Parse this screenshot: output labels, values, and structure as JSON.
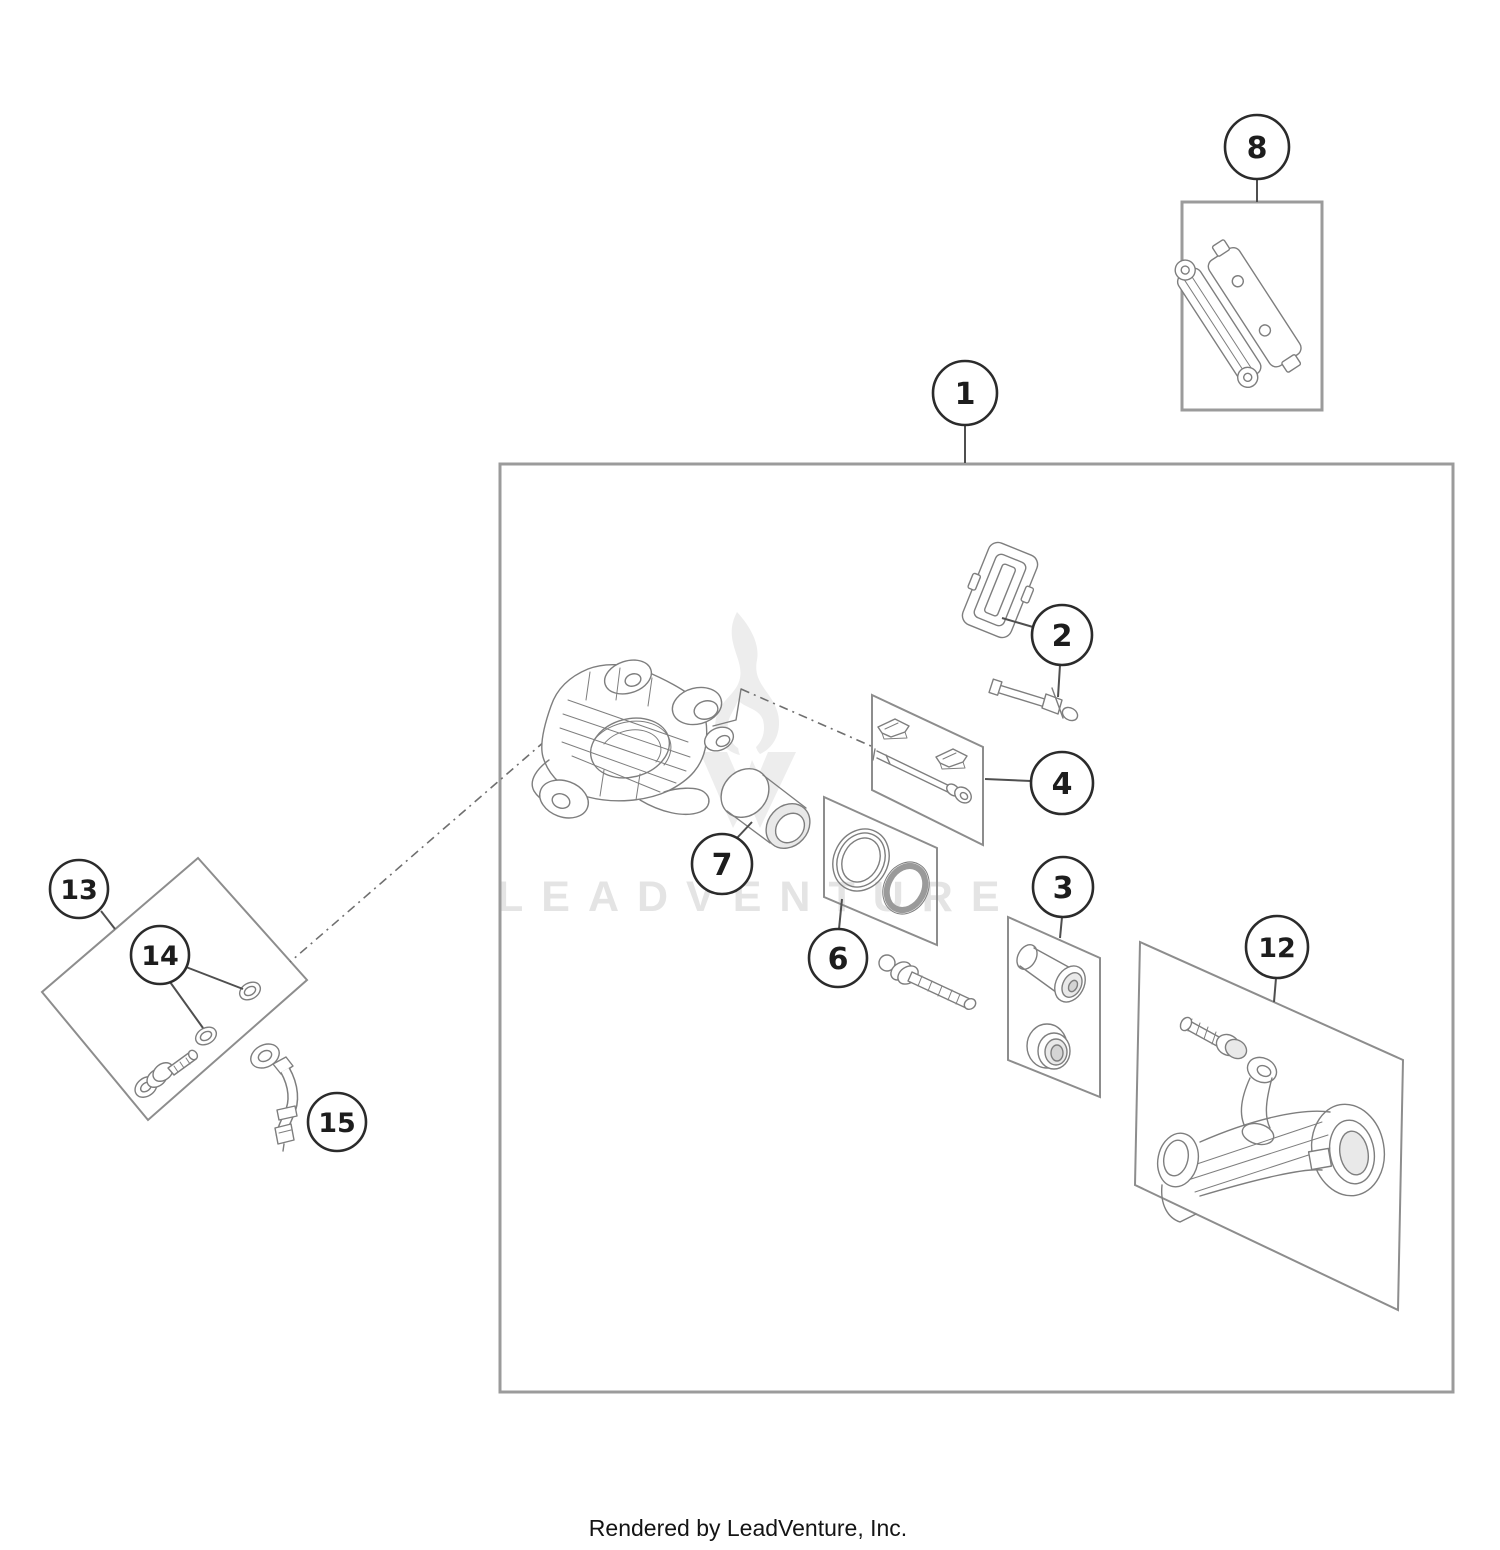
{
  "page": {
    "watermark": "LEADVENTURE",
    "footer": "Rendered by LeadVenture, Inc."
  },
  "colors": {
    "frame": "#9b9b9b",
    "inner_box": "#8d8d8d",
    "callout_stroke": "#2b2b2b",
    "leader": "#4f4f4f",
    "part_line": "#7e7e7e",
    "watermark": "#e4e4e4",
    "footer_text": "#141414"
  },
  "callouts": [
    {
      "label": "1"
    },
    {
      "label": "2"
    },
    {
      "label": "3"
    },
    {
      "label": "4"
    },
    {
      "label": "6"
    },
    {
      "label": "7"
    },
    {
      "label": "8"
    },
    {
      "label": "12"
    },
    {
      "label": "13"
    },
    {
      "label": "14"
    },
    {
      "label": "15"
    }
  ]
}
